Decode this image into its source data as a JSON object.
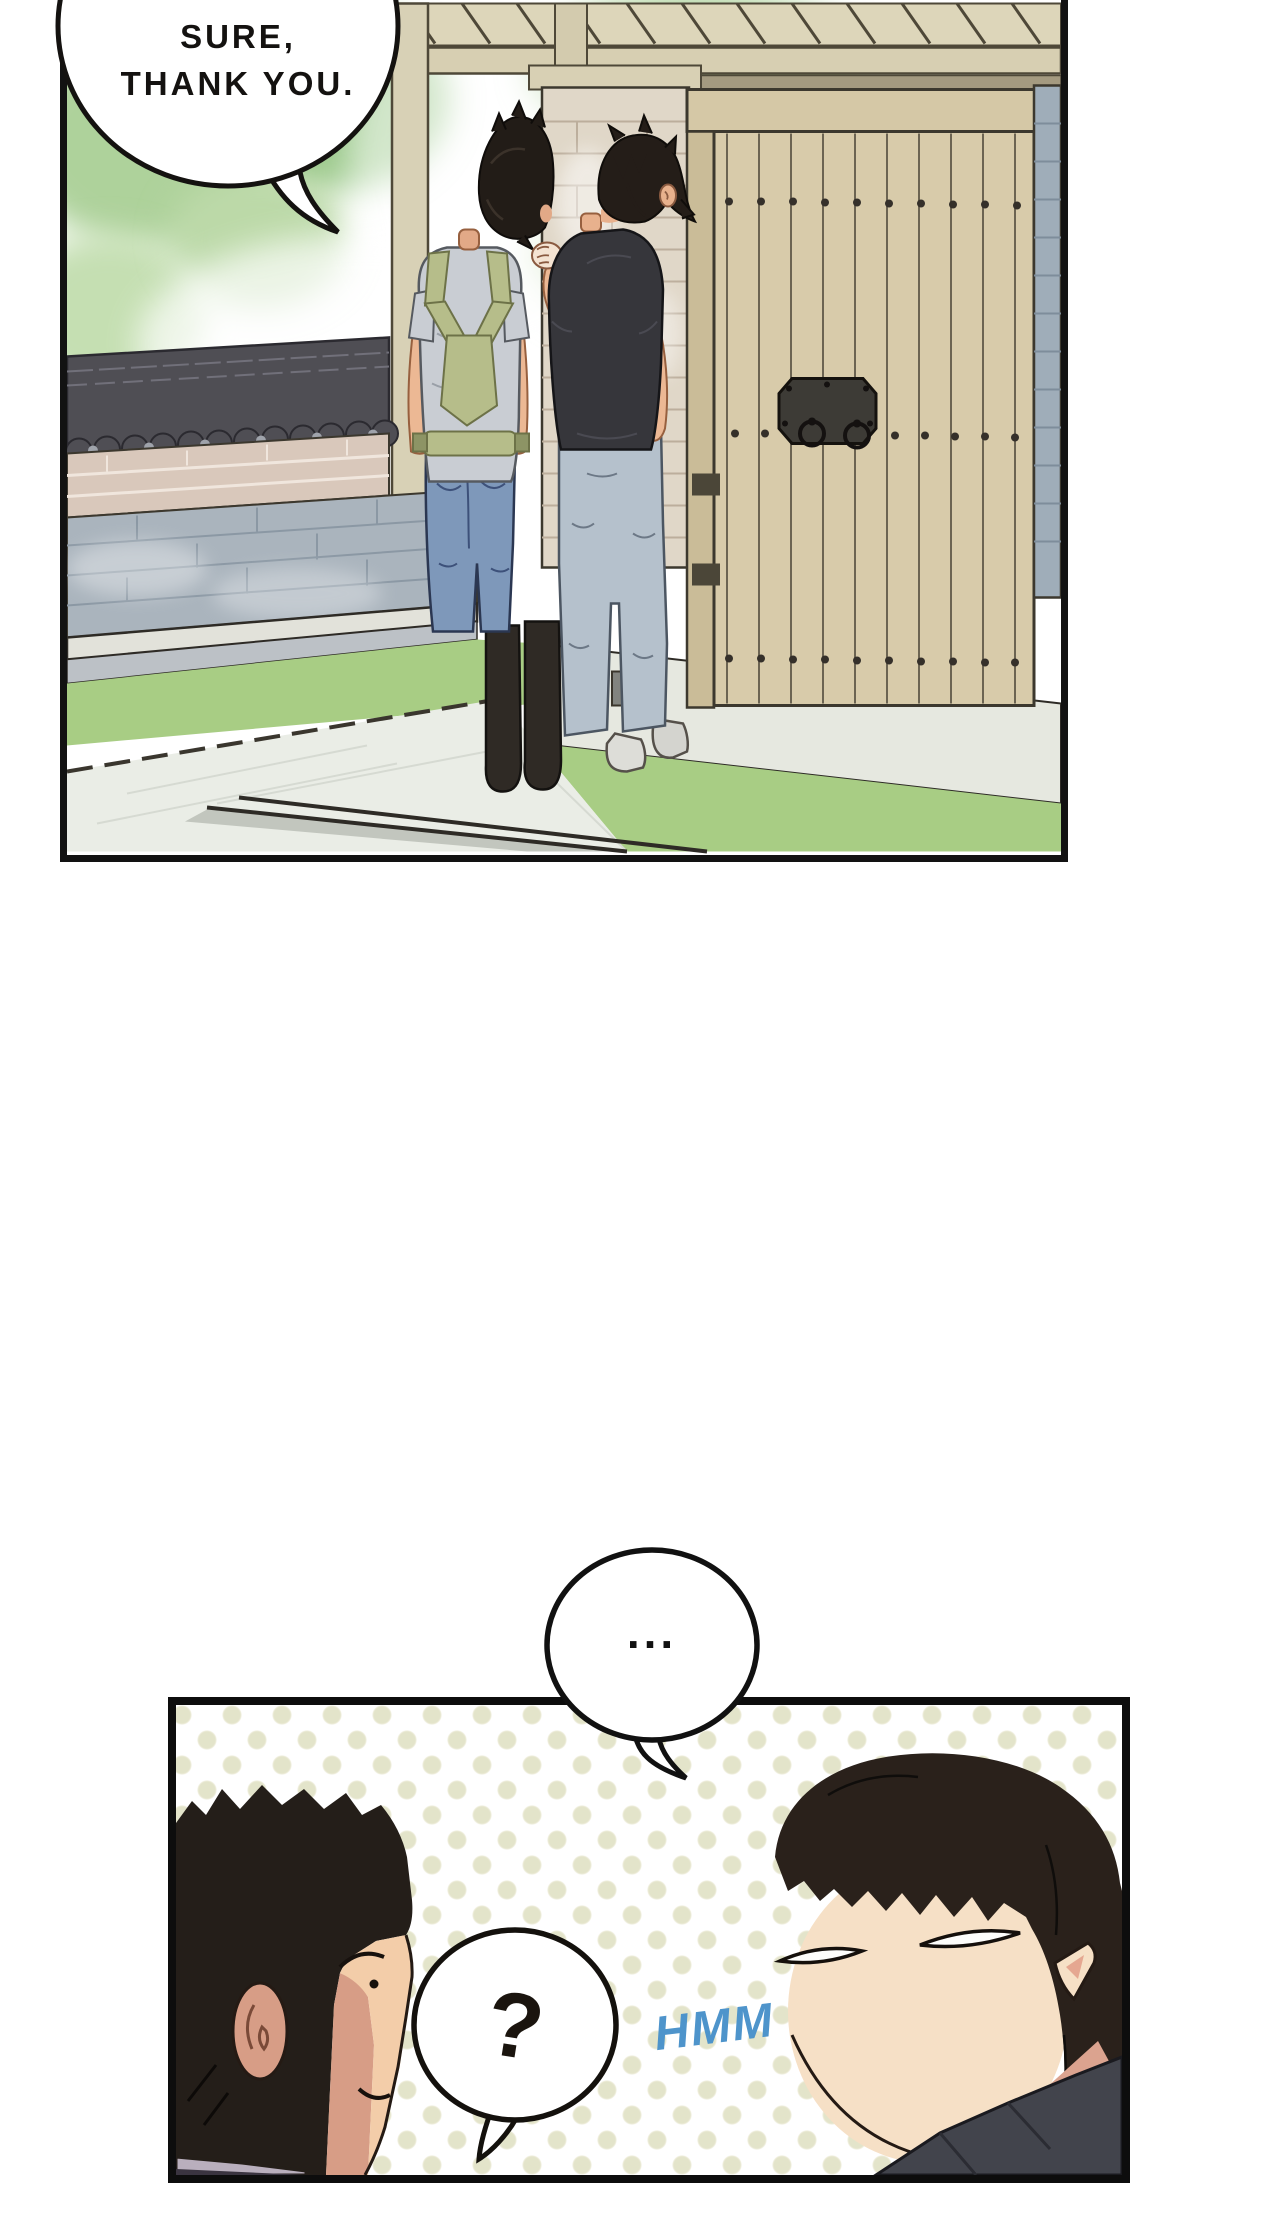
{
  "panel_top": {
    "speech_bubble": {
      "line1": "SURE,",
      "line2": "THANK YOU."
    }
  },
  "between_panels": {
    "ellipsis_bubble": {
      "text": "..."
    }
  },
  "panel_bottom": {
    "question_bubble": {
      "text": "?"
    },
    "sfx": {
      "text": "HMM",
      "color": "#4e94cb"
    }
  },
  "palette": {
    "panel_border": "#121212",
    "polka_dot": "#e3e4ca",
    "gate_wood": "#d8cbaa",
    "tile_roof": "#4f4e54",
    "stone_wall": "#aab4bd",
    "brick_band": "#d9c8bb",
    "grass": "#a8cd84",
    "stone_path": "#eaede6",
    "denim": "#7e98ba",
    "carrier_green": "#b6bd8a",
    "black_shirt": "#36363b",
    "skin": "#ecb894",
    "hmm_blue": "#4e94cb"
  }
}
